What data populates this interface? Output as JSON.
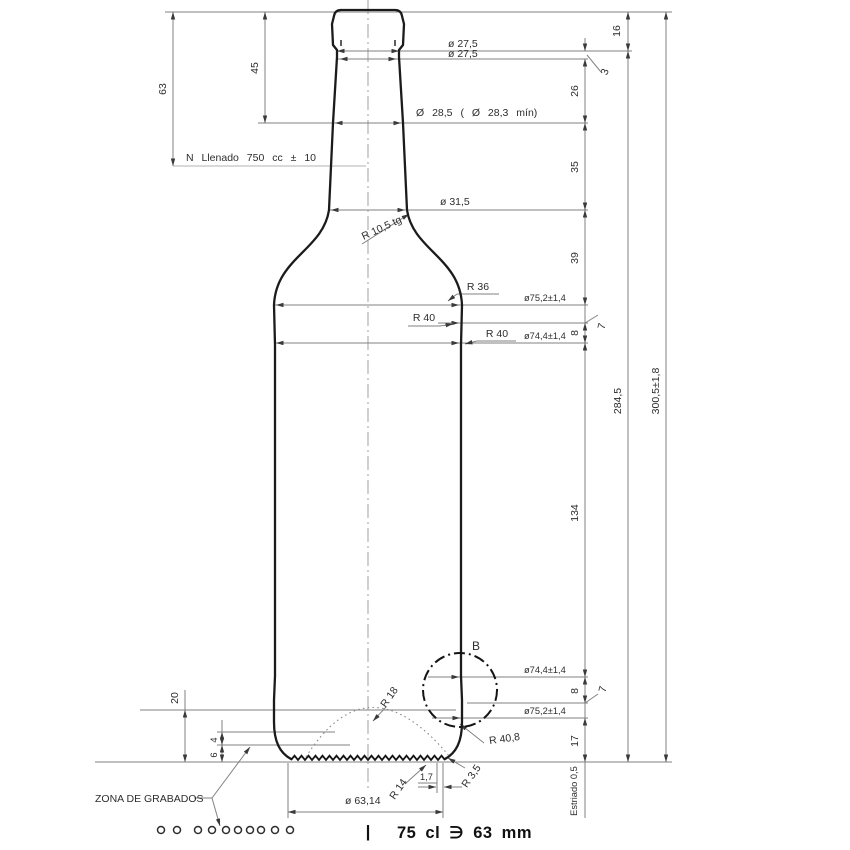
{
  "drawing": {
    "type": "wine-bottle technical drawing",
    "colors": {
      "outline": "#1b1b1b",
      "dimension": "#828282",
      "text": "#2d2d2d"
    },
    "labels": {
      "dia_27_5_a": "ø 27,5",
      "dia_27_5_b": "ø 27,5",
      "dia_28_5": "Ø 28,5 ( Ø 28,3 mín)",
      "fill_level": "N Llenado 750 cc ± 10",
      "dia_31_5": "ø 31,5",
      "r_10_5": "R 10,5 tg",
      "r_36": "R 36",
      "dia_75_2_top": "ø75,2±1,4",
      "r_40_a": "R 40",
      "r_40_b": "R 40",
      "dia_74_4_top": "ø74,4±1,4",
      "dim_16": "16",
      "dim_3": "3",
      "dim_26": "26",
      "dim_35": "35",
      "dim_39": "39",
      "dim_8_top": "8",
      "dim_7_top": "7",
      "dim_45": "45",
      "dim_63": "63",
      "dim_284_5": "284,5",
      "dim_300_5": "300,5±1,8",
      "dim_134": "134",
      "detail_marker": "B",
      "dia_74_4_bottom": "ø74,4±1,4",
      "dim_8_bottom": "8",
      "dim_7_bottom": "7",
      "dia_75_2_bottom": "ø75,2±1,4",
      "dim_17": "17",
      "dim_20": "20",
      "dim_4": "4",
      "dim_6": "6",
      "r_18": "R 18",
      "r_40_8": "R 40,8",
      "r_3_5": "R 3,5",
      "r_14": "R 14",
      "dim_1_7": "1,7",
      "dia_63_14": "ø 63,14",
      "knurl_note": "Estriado 0,5",
      "engraving_zone": "ZONA DE GRABADOS",
      "footer_divider": "|",
      "footer_spec": "75 cl ∋ 63 mm"
    }
  }
}
